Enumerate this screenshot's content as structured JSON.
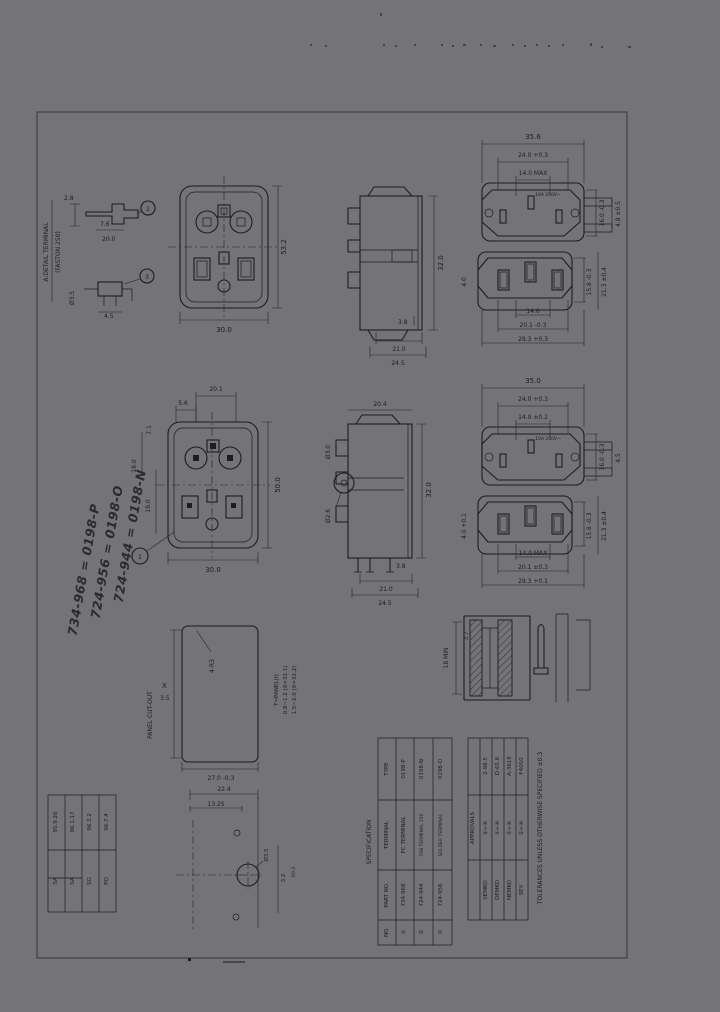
{
  "sheet": {
    "background": "#737378",
    "ink": "#1d1d21"
  },
  "labels": {
    "detail_caption_1": "A:DETAIL TERMINAL",
    "detail_caption_2": "(FASTON 250)",
    "panel_cutout_title": "PANEL CUT-OUT",
    "spec_title": "SPECIFICATION",
    "approvals_title": "APPROVALS",
    "side_note": "TOLERANCES UNLESS OTHERWISE SPECIFIED ±0.3"
  },
  "row1": {
    "detail_top": {
      "callout": "2",
      "dim_a": "2.8",
      "dim_b": "7.6",
      "dim_c": "20.0"
    },
    "detail_bottom": {
      "callout": "3",
      "dim_a": "Ø3.5",
      "dim_b": "4.5"
    },
    "rear": {
      "dim_bottom": "30.0",
      "dim_right": "53.2"
    },
    "side": {
      "dim_a": "3.8",
      "dim_b": "21.0",
      "dim_c": "24.5",
      "dim_right": "32.0"
    },
    "inlet": {
      "dim_w": "35.6",
      "dim_w2": "24.0 +0.3",
      "dim_w3": "14.0 MAX",
      "dim_r1": "16.0 -0.3",
      "dim_r2": "4.8 ±0.5",
      "marking": "10A 250V~"
    },
    "outlet": {
      "dim_b1": "14.0",
      "dim_b2": "20.1 -0.3",
      "dim_b3": "29.3 +0.3",
      "dim_r1": "15.8 -0.3",
      "dim_r2": "21.3 ±0.4",
      "dim_l": "4.0"
    }
  },
  "row2": {
    "rear": {
      "callout": "1",
      "dim_t1": "20.1",
      "dim_t2": "5.6",
      "dim_l1": "7.1",
      "dim_l2": "19.0",
      "dim_l3": "19.0",
      "dim_bottom": "30.0",
      "dim_right": "50.0"
    },
    "side": {
      "dim_top": "20.4",
      "dim_l1": "Ø3.0",
      "dim_l2": "Ø2.6",
      "dim_a": "3.8",
      "dim_b": "21.0",
      "dim_c": "24.5",
      "dim_right": "32.0"
    },
    "inlet": {
      "dim_w": "35.0",
      "dim_w2": "24.0 +0.3",
      "dim_w3": "14.0 ±0.2",
      "dim_r1": "16.0 -0.3",
      "dim_r2": "4.5",
      "marking": "10A 250V~"
    },
    "outlet": {
      "dim_b1": "14.0 MAX",
      "dim_b2": "20.1 ±0.3",
      "dim_b3": "29.3 +0.1",
      "dim_r1": "15.8 -0.3",
      "dim_r2": "21.3 ±0.4",
      "dim_l": "4.0 +0.1"
    }
  },
  "panel_cutout": {
    "corner": "4-R3",
    "x_label": "X",
    "x_sub": "3.5",
    "dim_bottom": "27.0 -0.3",
    "notes": [
      "T=PANEL(t)",
      "0.8~1.2 (X=32.1)",
      "1.5~2.0 (X=32.2)"
    ]
  },
  "section": {
    "dim_a": "18 MIN",
    "dim_b": "3.7"
  },
  "mounting": {
    "dim_t1": "22.4",
    "dim_t2": "13.25",
    "dim_hole": "Ø3.5",
    "dim_v": "3.2",
    "dim_r": "R0.3"
  },
  "handwritten": [
    "724-944 = 0198-N",
    "724-956 = 0198-O",
    "734-968 = 0198-P"
  ],
  "revision_table": {
    "cols": [
      {
        "date": "95.9.26",
        "by": "SA"
      },
      {
        "date": "96.1.17",
        "by": "SA"
      },
      {
        "date": "96.3.2",
        "by": "SG"
      },
      {
        "date": "96.7.4",
        "by": "PO"
      }
    ]
  },
  "spec_table": {
    "header": {
      "type": "TYPE",
      "terminal": "TERMINAL",
      "remark": "PART NO.",
      "mark": "NO."
    },
    "rows": [
      {
        "mark": "①",
        "terminal": "PC TERMINAL",
        "type": "0198-P",
        "remark": "734-968"
      },
      {
        "mark": "②",
        "terminal": "TAB TERMINAL 250",
        "type": "0198-N",
        "remark": "724-944"
      },
      {
        "mark": "③",
        "terminal": "SOLDER TERMINAL",
        "type": "0198-O",
        "remark": "724-956"
      }
    ]
  },
  "approvals_table": {
    "rows": [
      {
        "agency": "SEMKO",
        "mark": "①+④",
        "cert": "2-98.5"
      },
      {
        "agency": "DEMKO",
        "mark": "①+④",
        "cert": "D-65.6"
      },
      {
        "agency": "NEMKO",
        "mark": "②+④",
        "cert": "A-3618"
      },
      {
        "agency": "SEV",
        "mark": "②+④",
        "cert": "F4050"
      }
    ]
  }
}
